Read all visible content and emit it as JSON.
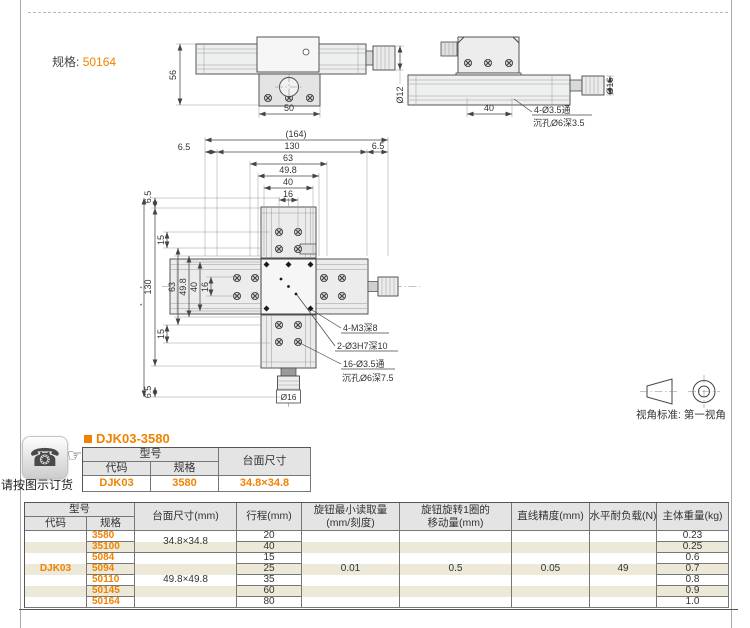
{
  "colors": {
    "accent": "#f08200",
    "stripe": "#ece9d8",
    "header_bg": "#e4e4e4"
  },
  "page": {
    "spec_label": "规格:",
    "spec_value": "50164"
  },
  "icons": {
    "phone": "☎",
    "hand": "☞"
  },
  "order": {
    "title": "DJK03-3580",
    "caption": "请按图示订货",
    "table": {
      "model": "型号",
      "code_h": "代码",
      "spec_h": "规格",
      "size_h": "台面尺寸",
      "code": "DJK03",
      "spec": "3580",
      "size": "34.8×34.8"
    }
  },
  "drawing": {
    "front": {
      "height": "56",
      "width": "50",
      "shaft": "Ø12"
    },
    "side": {
      "width": "40",
      "knob": "Ø16",
      "note1": "4-Ø3.5通",
      "note2": "沉孔Ø6深3.5"
    },
    "plan": {
      "total": "(164)",
      "outer": "130",
      "mid": "63",
      "plate": "49.8",
      "inner": "40",
      "pitch": "16",
      "margin": "6.5",
      "offset": "15",
      "knob": "Ø16",
      "note_m3": "4-M3深8",
      "note_h7": "2-Ø3H7深10",
      "note_thru": "16-Ø3.5通",
      "note_cb": "沉孔Ø6深7.5"
    },
    "view_standard": "视角标准: 第一视角"
  },
  "main_table": {
    "headers": {
      "model": "型号",
      "code": "代码",
      "spec": "规格",
      "size": "台面尺寸(mm)",
      "travel": "行程(mm)",
      "min1": "旋钮最小读取量",
      "min2": "(mm/刻度)",
      "turn1": "旋钮旋转1圈的",
      "turn2": "移动量(mm)",
      "accuracy": "直线精度(mm)",
      "load": "水平耐负载(N)",
      "weight": "主体重量(kg)"
    },
    "code": "DJK03",
    "size_groups": [
      {
        "size": "34.8×34.8"
      },
      {
        "size": "49.8×49.8"
      }
    ],
    "min_reading": "0.01",
    "per_turn": "0.5",
    "accuracy": "0.05",
    "load": "49",
    "rows": [
      {
        "spec": "3580",
        "travel": "20",
        "weight": "0.23"
      },
      {
        "spec": "35100",
        "travel": "40",
        "weight": "0.25"
      },
      {
        "spec": "5084",
        "travel": "15",
        "weight": "0.6"
      },
      {
        "spec": "5094",
        "travel": "25",
        "weight": "0.7"
      },
      {
        "spec": "50110",
        "travel": "35",
        "weight": "0.8"
      },
      {
        "spec": "50145",
        "travel": "60",
        "weight": "0.9"
      },
      {
        "spec": "50164",
        "travel": "80",
        "weight": "1.0"
      }
    ]
  }
}
